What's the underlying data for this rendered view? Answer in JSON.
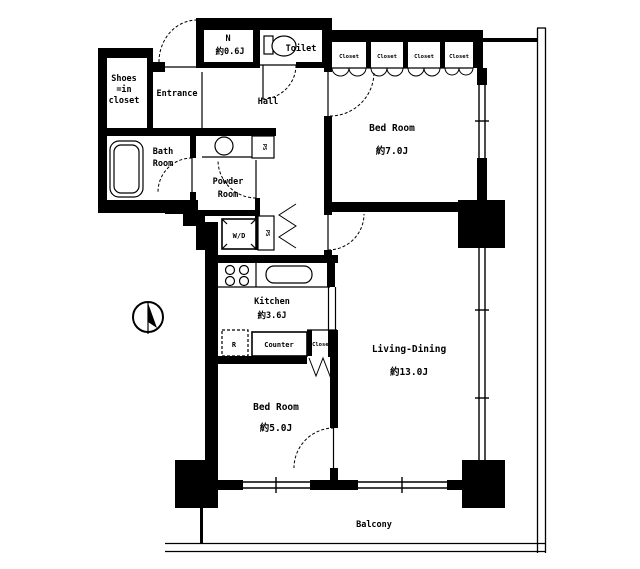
{
  "meta": {
    "type": "apartment-floor-plan",
    "colors": {
      "ink": "#000000",
      "background": "#ffffff"
    }
  },
  "labels": {
    "shoes_line1": "Shoes",
    "shoes_line2": "=in",
    "shoes_line3": "closet",
    "entrance": "Entrance",
    "n_name": "N",
    "n_area": "約0.6J",
    "toilet": "Toilet",
    "hall": "Hall",
    "bath_line1": "Bath",
    "bath_line2": "Room",
    "powder_line1": "Powder",
    "powder_line2": "Room",
    "wd": "W/D",
    "bedroom7_name": "Bed Room",
    "bedroom7_area": "約7.0J",
    "living_name": "Living-Dining",
    "living_area": "約13.0J",
    "kitchen_name": "Kitchen",
    "kitchen_area": "約3.6J",
    "bedroom5_name": "Bed Room",
    "bedroom5_area": "約5.0J",
    "balcony": "Balcony",
    "counter": "Counter",
    "fridge": "R",
    "closet": "Closet",
    "shaft": "PS"
  }
}
